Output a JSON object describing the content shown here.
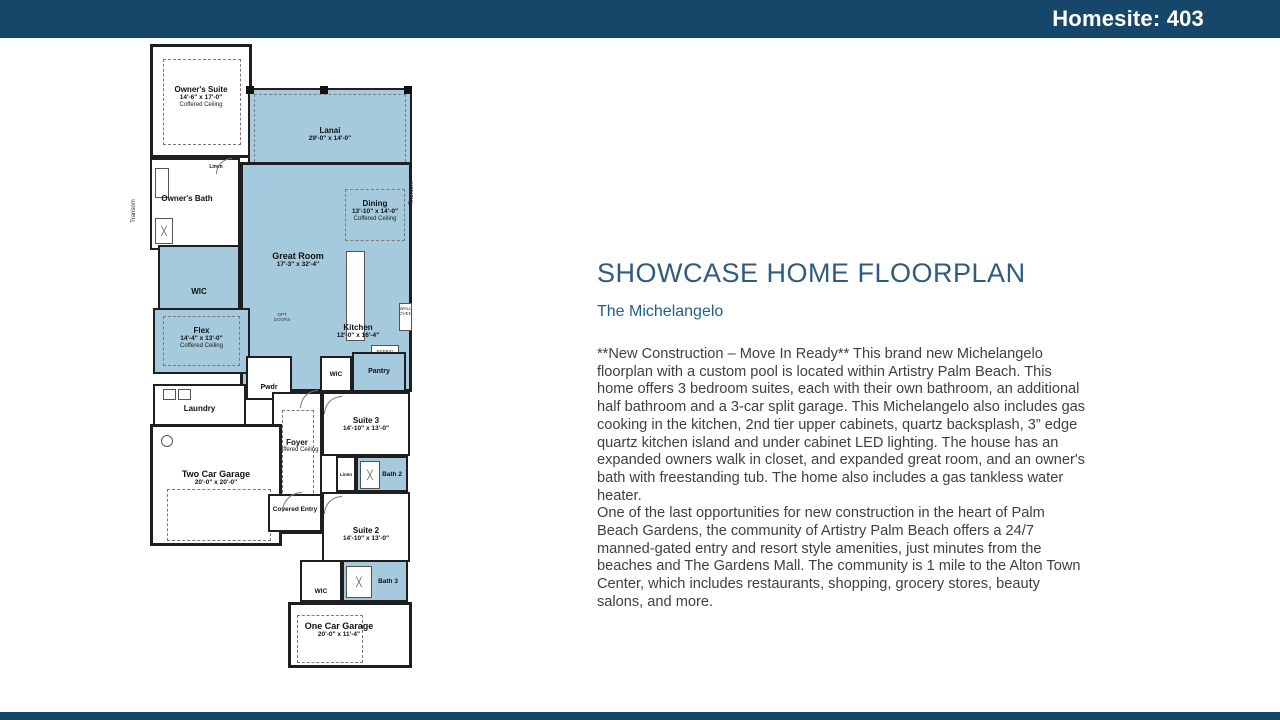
{
  "header": {
    "homesite_label": "Homesite: 403"
  },
  "colors": {
    "bar_navy": "#17466b",
    "plan_blue": "#a5cadd",
    "title_blue": "#2f5c7c",
    "subtitle_blue": "#1f618e"
  },
  "content": {
    "title": "SHOWCASE HOME FLOORPLAN",
    "subtitle": "The Michelangelo",
    "paragraphs": [
      "**New Construction – Move In Ready** This brand new Michelangelo floorplan with a custom pool is located within Artistry Palm Beach. This home offers 3 bedroom suites, each with their own bathroom, an additional half bathroom and a 3-car split garage. This Michelangelo also includes gas cooking in the kitchen, 2nd tier upper cabinets, quartz backsplash, 3” edge quartz kitchen island and under cabinet LED lighting. The house has an expanded owners walk in closet, and expanded great room, and an owner's bath with freestanding tub. The home also includes a gas tankless water heater.",
      "One of the last opportunities for new construction in the heart of Palm Beach Gardens, the community of Artistry Palm Beach offers a 24/7 manned-gated entry and resort style amenities, just minutes from the beaches and The Gardens Mall. The community is 1 mile to the Alton Town Center, which includes restaurants, shopping, grocery stores, beauty salons, and more."
    ]
  },
  "floorplan": {
    "owners_suite": {
      "name": "Owner's Suite",
      "dims": "14'-6\" x 17'-0\"",
      "note": "Coffered Ceiling"
    },
    "lanai": {
      "name": "Lanai",
      "dims": "29'-0\" x 14'-0\""
    },
    "owners_bath": {
      "name": "Owner's Bath"
    },
    "linen1": {
      "name": "Linen"
    },
    "wic1": {
      "name": "WIC"
    },
    "dining": {
      "name": "Dining",
      "dims": "13'-10\" x 14'-0\"",
      "note": "Coffered Ceiling"
    },
    "great_room": {
      "name": "Great Room",
      "dims": "17'-3\" x 32'-4\""
    },
    "flex": {
      "name": "Flex",
      "dims": "14'-4\" x 13'-0\"",
      "note": "Coffered Ceiling"
    },
    "kitchen": {
      "name": "Kitchen",
      "dims": "12'-0\" x 16'-4\""
    },
    "pwdr": {
      "name": "Pwdr"
    },
    "wic2": {
      "name": "WIC"
    },
    "pantry": {
      "name": "Pantry"
    },
    "laundry": {
      "name": "Laundry"
    },
    "foyer": {
      "name": "Foyer",
      "note": "Coffered Ceiling"
    },
    "suite3": {
      "name": "Suite 3",
      "dims": "14'-10\" x 13'-0\""
    },
    "two_car_garage": {
      "name": "Two Car Garage",
      "dims": "20'-0\" x 20'-0\""
    },
    "linen2": {
      "name": "Linen"
    },
    "bath2": {
      "name": "Bath 2"
    },
    "covered_entry": {
      "name": "Covered Entry"
    },
    "suite2": {
      "name": "Suite 2",
      "dims": "14'-10\" x 13'-0\""
    },
    "wic3": {
      "name": "WIC"
    },
    "bath3": {
      "name": "Bath 3"
    },
    "one_car_garage": {
      "name": "One Car Garage",
      "dims": "20'-0\" x 11'-4\""
    },
    "transom": "Transom",
    "opt_doors": "OPT DOORS",
    "wall_oven": "WALL OVEN",
    "refrig": "REFRIG"
  }
}
